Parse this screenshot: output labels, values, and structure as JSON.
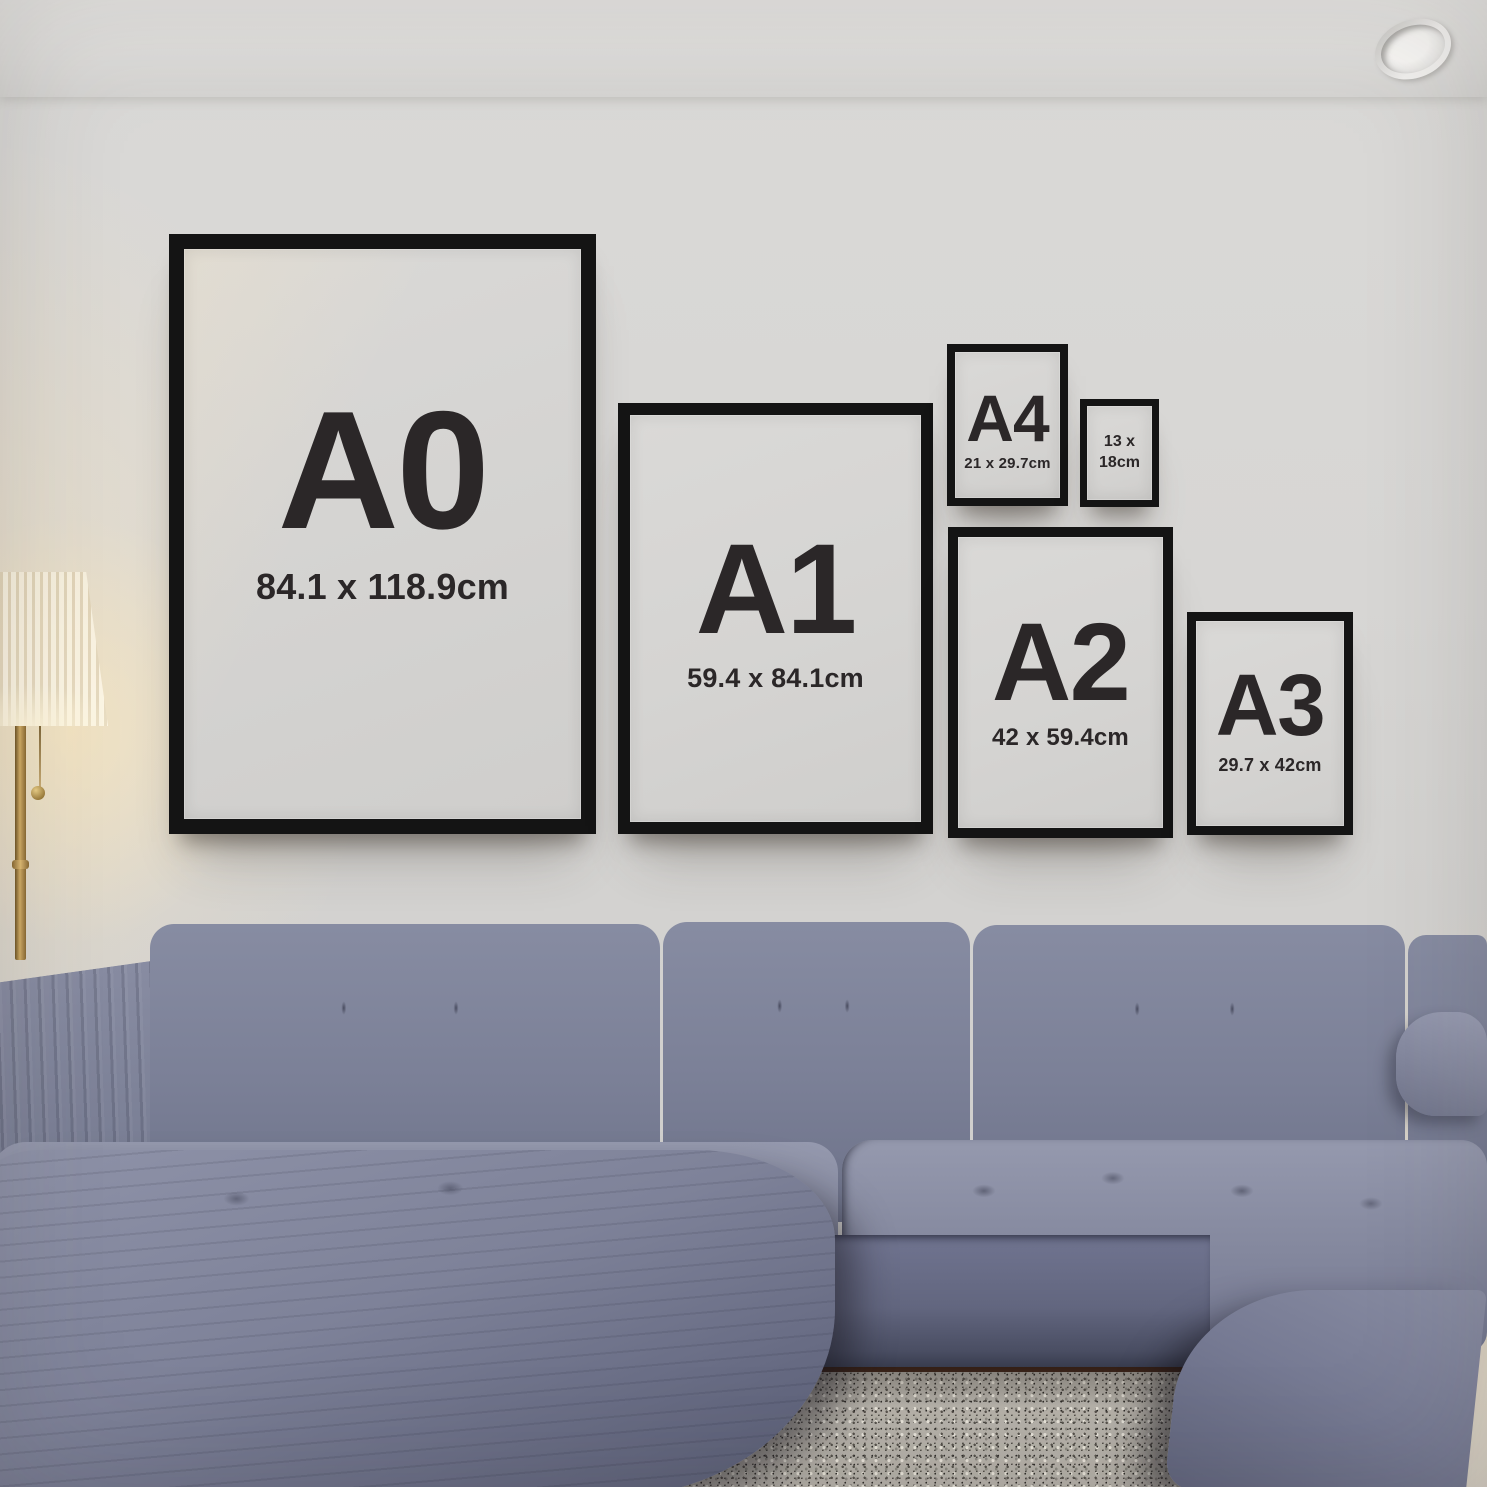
{
  "frames": [
    {
      "id": "a0",
      "title": "A0",
      "subtitle": "84.1 x 118.9cm"
    },
    {
      "id": "a1",
      "title": "A1",
      "subtitle": "59.4 x 84.1cm"
    },
    {
      "id": "a4",
      "title": "A4",
      "subtitle": "21 x 29.7cm"
    },
    {
      "id": "13x18",
      "title": "13 x",
      "subtitle": "18cm"
    },
    {
      "id": "a2",
      "title": "A2",
      "subtitle": "42 x 59.4cm"
    },
    {
      "id": "a3",
      "title": "A3",
      "subtitle": "29.7 x 42cm"
    }
  ],
  "palette": {
    "frame_black": "#141414",
    "poster_paper": "#d5d4d2",
    "label_text": "#2b2728",
    "wall": "#d7d6d4",
    "ceiling": "#e0dfdd",
    "sofa_fabric": "#7a7e95",
    "rug": "#b5b1a9",
    "floor_wood": "#3a241a",
    "lamp_shade": "#f6edd8",
    "lamp_brass": "#b3924e"
  }
}
